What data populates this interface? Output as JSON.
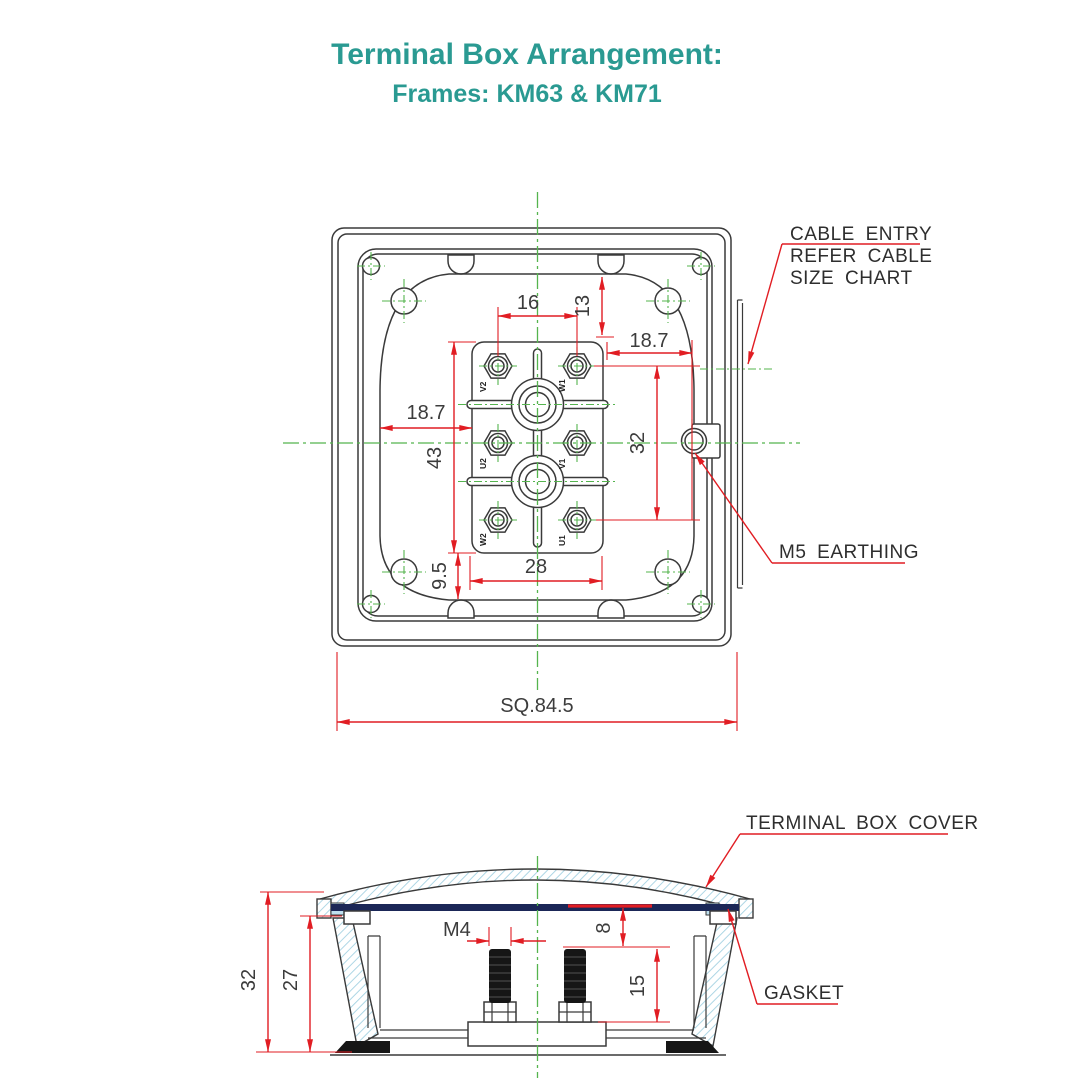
{
  "title": {
    "heading": "Terminal Box Arrangement:",
    "subheading": "Frames: KM63 & KM71"
  },
  "top_view": {
    "dims": {
      "terminal_pitch": "16",
      "boss_to_block": "13",
      "block_to_cable_entry": "18.7",
      "terminal_rows_span": "32",
      "recess_to_block": "18.7",
      "block_height": "43",
      "block_to_recess_bottom": "9.5",
      "outer_terminal_pitch": "28",
      "overall_square": "SQ.84.5"
    },
    "terminals": [
      "V2",
      "W1",
      "U2",
      "V1",
      "W2",
      "U1"
    ],
    "callouts": {
      "cable_entry": [
        "CABLE ENTRY",
        "REFER CABLE",
        "SIZE CHART"
      ],
      "earthing": "M5 EARTHING"
    }
  },
  "side_view": {
    "dims": {
      "overall_depth": "32",
      "inner_depth": "27",
      "stud_thread": "M4",
      "gasket_to_thread": "8",
      "thread_length": "15"
    },
    "callouts": {
      "cover": "TERMINAL BOX COVER",
      "gasket": "GASKET"
    }
  },
  "colors": {
    "accent_teal": "#2a9a92",
    "dimension_red": "#e11d23",
    "centerline_green": "#55b44e",
    "line_dark": "#3a3a3a",
    "hatch_blue": "#a5d2e2",
    "gasket_navy": "#1b2757"
  }
}
